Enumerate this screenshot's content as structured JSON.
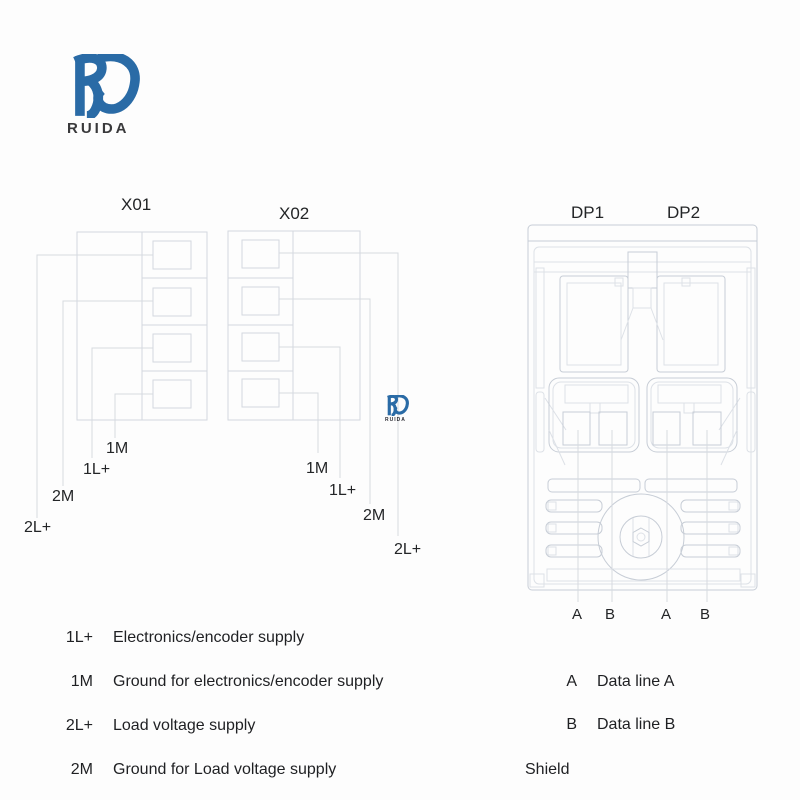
{
  "colors": {
    "brand_blue": "#2a6ba6",
    "text": "#1f2023",
    "line_light": "#dde1e7",
    "line_mid": "#c7cdd6",
    "line_block": "#d3d8df"
  },
  "logo": {
    "monogram": "RD",
    "name": "RUIDA"
  },
  "watermark": {
    "monogram": "RD",
    "name": "RUIDA"
  },
  "blocks": {
    "x01": {
      "title": "X01",
      "pins": {
        "pin_1m": "1M",
        "pin_1l": "1L+",
        "pin_2m": "2M",
        "pin_2l": "2L+"
      }
    },
    "x02": {
      "title": "X02",
      "pins": {
        "pin_1m": "1M",
        "pin_1l": "1L+",
        "pin_2m": "2M",
        "pin_2l": "2L+"
      }
    },
    "dp": {
      "dp1_title": "DP1",
      "dp2_title": "DP2",
      "pin_labels": [
        "A",
        "B",
        "A",
        "B"
      ]
    }
  },
  "legend": {
    "power": [
      {
        "term": "1L+",
        "desc": "Electronics/encoder supply"
      },
      {
        "term": "1M",
        "desc": "Ground for electronics/encoder supply"
      },
      {
        "term": "2L+",
        "desc": "Load voltage supply"
      },
      {
        "term": "2M",
        "desc": "Ground for Load voltage supply"
      }
    ],
    "data": [
      {
        "term": "A",
        "desc": "Data line A"
      },
      {
        "term": "B",
        "desc": "Data line B"
      }
    ],
    "shield": "Shield"
  }
}
